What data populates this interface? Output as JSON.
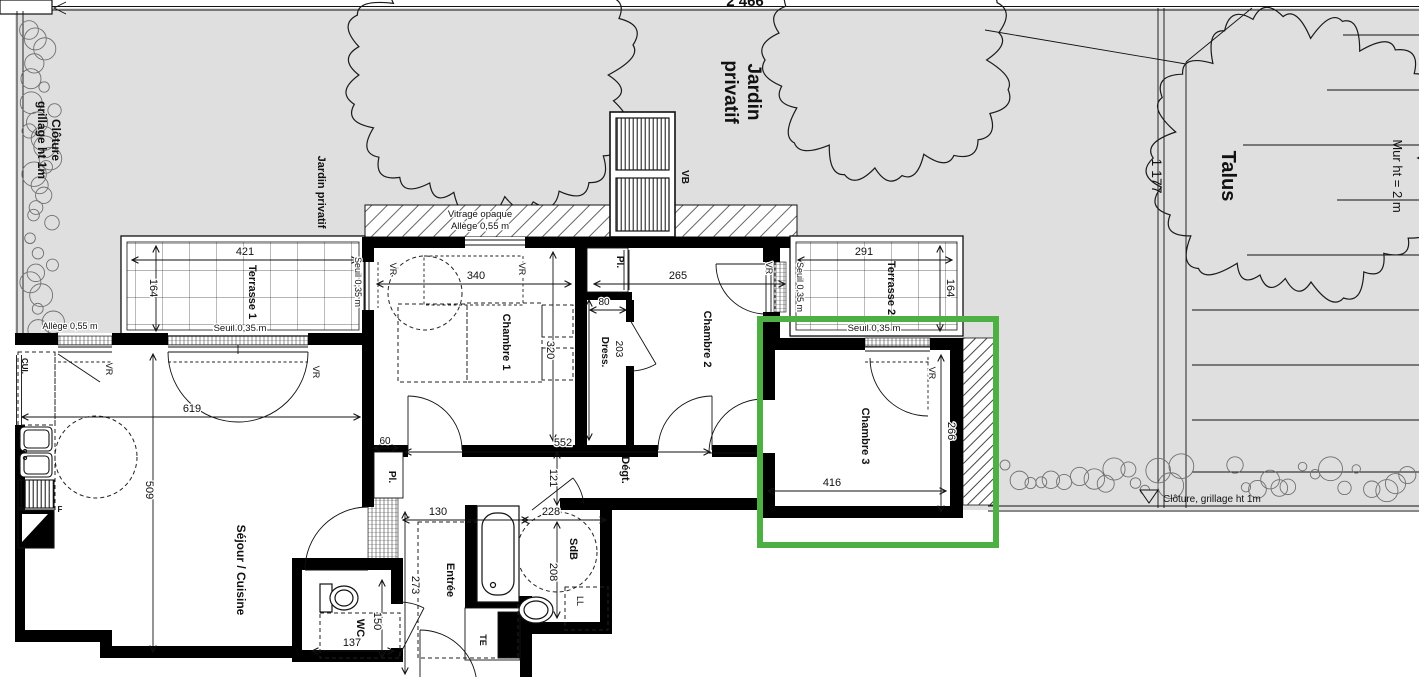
{
  "site": {
    "top_dim": "2 466",
    "fence_left_1": "Clôture",
    "fence_left_2": "grillage ht 1m",
    "fence_bottom_note": "Clôture, grillage ht 1m",
    "garden_label_small": "Jardin privatif",
    "garden_label_large_1": "Jardin",
    "garden_label_large_2": "privatif",
    "talus": "Talus",
    "talus_dim": "1 177",
    "wall_note": "Mur ht = 2 m"
  },
  "annotations": {
    "vitrage_1": "Vitrage opaque",
    "vitrage_2": "Allège 0,55 m",
    "allege": "Allège 0,55 m",
    "seuil": "Seuil 0,35 m",
    "vr": "VR",
    "vb": "VB",
    "cui": "CUI.",
    "fridge": "F",
    "te": "TE",
    "ll": "LL",
    "pl": "Pl."
  },
  "rooms": {
    "terrasse1": {
      "label": "Terrasse 1",
      "w": "421",
      "h": "164"
    },
    "chambre1": {
      "label": "Chambre 1",
      "w": "340",
      "h": "320"
    },
    "chambre2": {
      "label": "Chambre 2",
      "w": "265"
    },
    "terrasse2": {
      "label": "Terrasse 2",
      "w": "291",
      "h": "164"
    },
    "chambre3": {
      "label": "Chambre 3",
      "w": "416",
      "h": "266"
    },
    "sejour": {
      "label": "Séjour / Cuisine",
      "w": "619",
      "h": "509"
    },
    "entree": {
      "label": "Entrée",
      "w": "130",
      "h": "273"
    },
    "wc": {
      "label": "WC",
      "w": "137",
      "h": "150"
    },
    "sdb": {
      "label": "SdB",
      "w": "228",
      "h": "208"
    },
    "degt": {
      "label": "Dégt.",
      "w": "552",
      "h": "121"
    },
    "dress": {
      "label": "Dress.",
      "w": "80",
      "h": "203"
    },
    "pl_entree": {
      "label": "Pl.",
      "w": "60"
    }
  },
  "highlight": {
    "highlighted_room": "Chambre 3",
    "color": "#4db043"
  }
}
